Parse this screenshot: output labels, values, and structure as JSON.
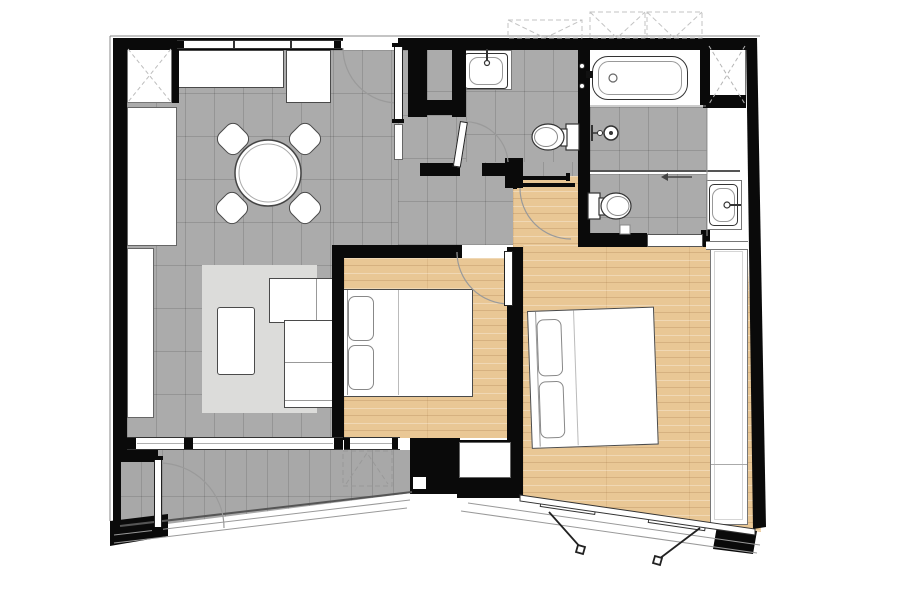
{
  "title": "Two-bedroom apartment floor plan",
  "colors": {
    "wall": "#0a0a0a",
    "tile": "#ababab",
    "balcony": "#a8a8a8",
    "wood": "#e9c795",
    "white": "#ffffff",
    "rug": "#dcdcda",
    "outline": "#4a4a4a",
    "dash": "#bdbdbd",
    "arc": "#9a9a9a"
  },
  "rooms": {
    "living_dining": {
      "label": "Living and dining area, tiled floor"
    },
    "entry": {
      "label": "Entry hall"
    },
    "corridor": {
      "label": "Corridor"
    },
    "bedroom1": {
      "label": "Bedroom 1, wood floor"
    },
    "bedroom2": {
      "label": "Bedroom 2, wood floor"
    },
    "bathroom1": {
      "label": "Bathroom with washbasin and toilet"
    },
    "bathtub_room": {
      "label": "Bathtub room"
    },
    "shower": {
      "label": "Shower area"
    },
    "wc": {
      "label": "WC with toilet"
    },
    "vanity": {
      "label": "Vanity corridor with washbasin"
    },
    "shaft": {
      "label": "Service shaft"
    },
    "balcony": {
      "label": "Angled balcony"
    }
  },
  "furniture": {
    "wardrobe_top": {
      "label": "Built-in wardrobe with X symbol"
    },
    "kitchen_counter": {
      "label": "Kitchen counter"
    },
    "fridge": {
      "label": "Refrigerator / appliance unit"
    },
    "tall_cabinet": {
      "label": "Tall cabinet"
    },
    "console": {
      "label": "TV console"
    },
    "dining_table": {
      "label": "Round dining table with four chairs"
    },
    "sofa": {
      "label": "L-shaped sofa"
    },
    "coffee_table": {
      "label": "Coffee table"
    },
    "area_rug": {
      "label": "Area rug"
    },
    "bed1": {
      "label": "Double bed with two pillows"
    },
    "bed2": {
      "label": "Double bed with two pillows"
    },
    "wardrobe2": {
      "label": "Bedroom 2 wardrobe"
    },
    "bathtub": {
      "label": "Bathtub"
    },
    "washbasin1": {
      "label": "Washbasin"
    },
    "washbasin2": {
      "label": "Washbasin"
    },
    "toilet1": {
      "label": "Toilet"
    },
    "toilet2": {
      "label": "Toilet"
    },
    "shower_head": {
      "label": "Wall-mounted shower head"
    },
    "ac_unit": {
      "label": "Air-conditioner unit, dashed outline"
    },
    "roof_units": {
      "label": "Dashed overhead units"
    }
  },
  "openings": {
    "entry_door": {
      "label": "Entry door with swing arc"
    },
    "bedroom1_door": {
      "label": "Bedroom 1 door with swing arc"
    },
    "bedroom2_door": {
      "label": "Bedroom 2 sliding door"
    },
    "bathroom1_door": {
      "label": "Bathroom door"
    },
    "balcony_door": {
      "label": "Balcony door with swing arc"
    },
    "shower_screen": {
      "label": "Sliding shower screen"
    },
    "living_sliding_window": {
      "label": "Living room sliding window"
    },
    "bedroom1_window": {
      "label": "Bedroom 1 window to balcony"
    },
    "facade_windows": {
      "label": "Angled facade casement windows"
    }
  }
}
